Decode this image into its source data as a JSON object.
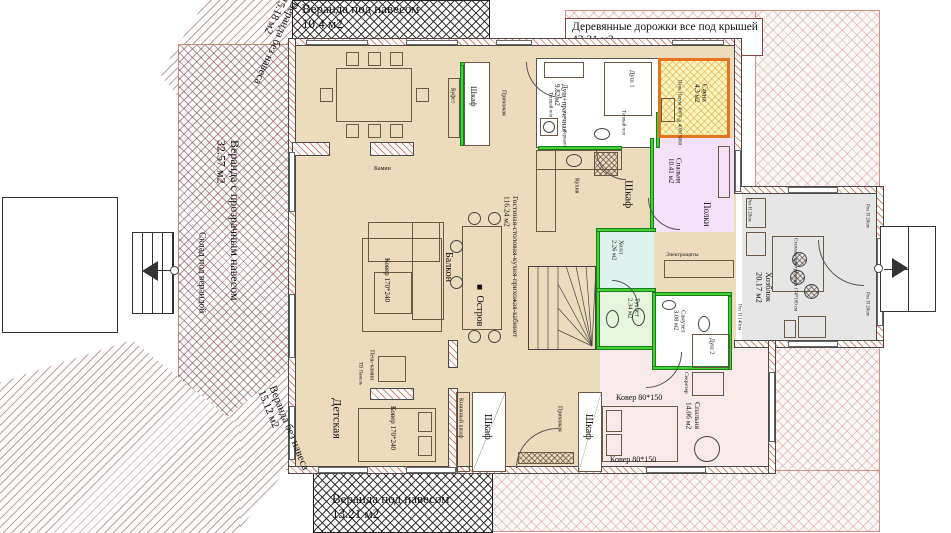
{
  "outdoor": {
    "veranda_top_left": {
      "name": "Веранда без навеса",
      "area": "15.18 м2"
    },
    "veranda_top": {
      "name": "Веранда под навесом",
      "area": "10.4 м2"
    },
    "walkways": {
      "name": "Деревянные дорожки все под крышей",
      "area": "43.31 м2"
    },
    "veranda_left": {
      "name": "Веранда с прозрачным навесом",
      "area": "32.57 м2"
    },
    "storage_under_veranda": {
      "name": "Склад под верандой"
    },
    "veranda_bottom_left": {
      "name": "Веранда без навеса",
      "area": "15.12 м2"
    },
    "veranda_bottom": {
      "name": "Веранда под навесом",
      "area": "13.21 м2"
    }
  },
  "rooms": {
    "living": {
      "name": "Гостиная-столовая-кухня-прихожая-кабинет",
      "area": "116.24 м2"
    },
    "shower_laundry": {
      "name": "Душ+прачечная",
      "area": "9.82 м2"
    },
    "shower1": {
      "name": "Душ 1"
    },
    "sauna": {
      "name": "Сауна",
      "area": "4.3 м2",
      "note": "Печь Harvia 400V №4000 5060"
    },
    "bedroom1": {
      "name": "Спальня",
      "area": "10.41 м2"
    },
    "hall": {
      "name": "Холл",
      "area": "2.26 м2"
    },
    "toilet": {
      "name": "Туалет",
      "area": "2.34 м2"
    },
    "bathroom": {
      "name": "Санузел",
      "area": "3.08 м2"
    },
    "shower2": {
      "name": "Душ 2"
    },
    "utility": {
      "name": "Хозблок",
      "area": "20.17 м2"
    },
    "bedroom2": {
      "name": "Спальня",
      "area": "14.06 м2"
    },
    "kids_room": {
      "name": "Детская"
    },
    "balcony": {
      "name": "Балкон"
    }
  },
  "items": {
    "wardrobe": "Шкаф",
    "buffet": "Буфет",
    "kitchen": "Кухня",
    "island": "Остров",
    "island_marker": "■",
    "fireplace": "Камин",
    "rug_170": "Ковер 170*240",
    "stove_fireplace": "Печь-камин",
    "tv_panel": "ТВ Панель",
    "bookcase": "Книжный шкаф",
    "entry": "Прихожая",
    "rug_80": "Ковер 80*150",
    "secretary": "Секретер",
    "shelves": "Полки",
    "rack": "Стеллаж для хранения 174*100 см",
    "electro": "Электрощиты",
    "warm_floor": "Теплый пол",
    "mirror": "Зеркало",
    "socket_20": "Роз Н 20см",
    "socket_140": "Роз Н 140см"
  },
  "colors": {
    "floor": "#eddcbc",
    "bedroom1": "#f3e2f7",
    "bedroom2": "#f8e9ea",
    "hall": "#ddf4ee",
    "toilet_fill": "#e6f5dc",
    "utility": "#e6e6e6",
    "sauna_fill": "#fbf7c0",
    "sauna_border": "#e2751d",
    "green_wall": "#3fd433"
  }
}
